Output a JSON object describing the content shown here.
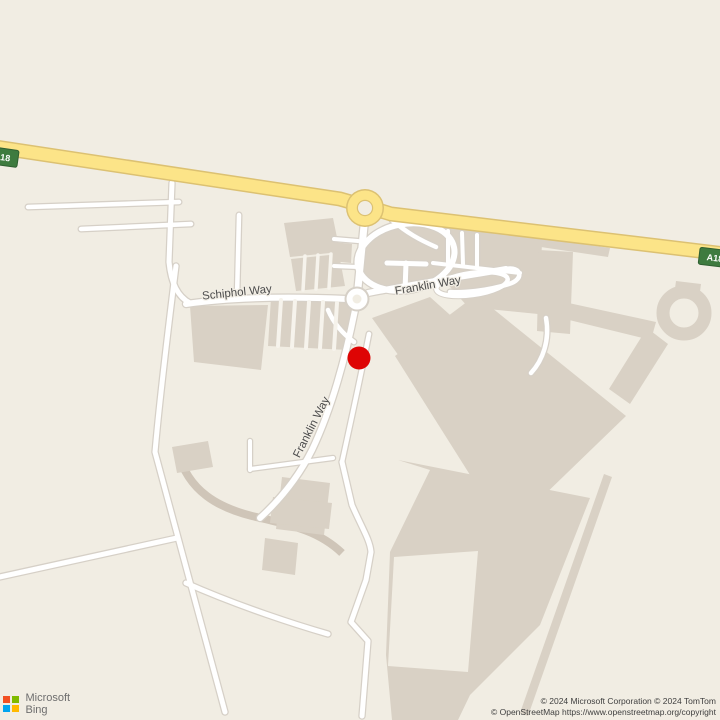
{
  "map": {
    "kind": "bing-road-map",
    "street_labels": [
      {
        "id": "schiphol-way",
        "text": "Schiphol Way"
      },
      {
        "id": "franklin-way-east",
        "text": "Franklin Way"
      },
      {
        "id": "franklin-way-south",
        "text": "Franklin Way"
      }
    ],
    "shields": {
      "left": "A18",
      "right": "A18"
    },
    "marker": {
      "x": 359,
      "y": 358,
      "color": "#de0404"
    },
    "colors": {
      "background": "#f1ede3",
      "building_area": "#d9d1c5",
      "perimeter_track": "#cfc5b8",
      "road_fill": "#ffffff",
      "road_casing": "#d6d0c7",
      "primary_road_fill": "#fce488",
      "primary_road_casing": "#dcc172",
      "shield_green": "#3e7b3f"
    }
  },
  "branding": {
    "company": "Microsoft",
    "product": "Bing",
    "logo_colors": {
      "tl": "#f25022",
      "tr": "#7fba00",
      "bl": "#00a4ef",
      "br": "#ffb900"
    }
  },
  "attribution": {
    "line1": "© 2024 Microsoft Corporation © 2024 TomTom",
    "line2": "© OpenStreetMap https://www.openstreetmap.org/copyright"
  }
}
